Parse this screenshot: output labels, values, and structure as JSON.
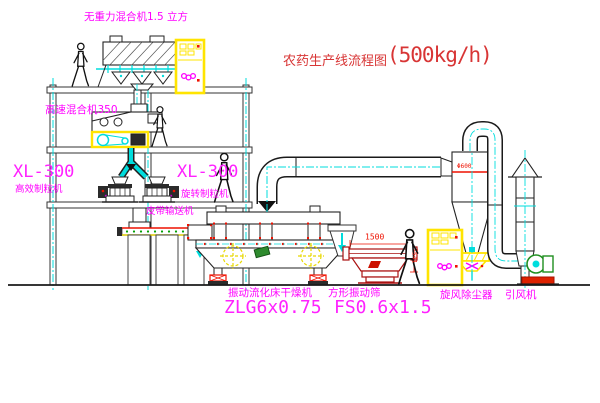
{
  "title": {
    "name": "农药生产线流程图",
    "capacity": "(500kg/h)"
  },
  "equipment_labels": {
    "gravity_mixer": "无重力混合机1.5 立方",
    "high_speed_mixer": "高速混合机350",
    "granulator_left_model": "XL-300",
    "granulator_left_name": "高效制粒机",
    "granulator_center_model": "XL-300",
    "granulator_center_name": "旋转制粒机",
    "belt_conveyor": "皮带输送机",
    "fluid_bed_dryer_name": "振动流化床干燥机",
    "fluid_bed_dryer_model": "ZLG6x0.75",
    "square_sieve_name": "方形振动筛",
    "square_sieve_model": "FS0.6x1.5",
    "cyclone": "旋风除尘器",
    "induced_draft_fan": "引风机"
  },
  "dimensions": {
    "sieve_length": "1500",
    "sieve_side": "541",
    "cyclone_note": "Φ600"
  },
  "colors": {
    "label_magenta": "#ff00ff",
    "title_red": "#d83535",
    "centerline_cyan": "#00dddd",
    "highlight_yellow": "#ffe400",
    "drawing_line": "#1a1a1a",
    "sieve_darkred": "#aa1111",
    "accent_red": "#ee1100",
    "fan_green": "#1f8f1f"
  }
}
